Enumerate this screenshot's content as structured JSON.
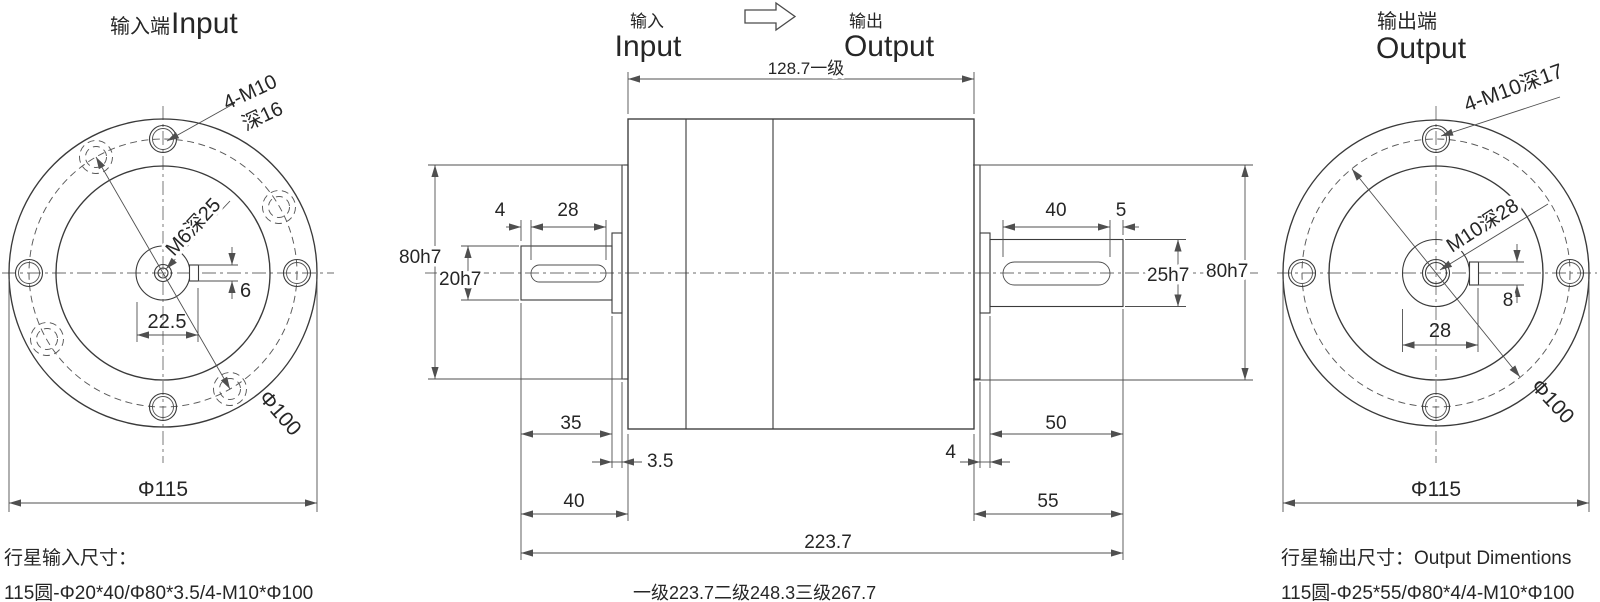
{
  "drawing": {
    "left": {
      "title_cn": "输入端",
      "title_en": "Input",
      "leader_bolts_1": "4-M10",
      "leader_bolts_2": "深16",
      "leader_center": "M6深25",
      "dim_key_offset": "22.5",
      "dim_key_width": "6",
      "dim_bolt_circle": "Φ100",
      "dim_outer": "Φ115",
      "note_title": "行星输入尺寸：",
      "note_spec": "115圆-Φ20*40/Φ80*3.5/4-M10*Φ100"
    },
    "middle": {
      "label_input_cn": "输入",
      "label_input_en": "Input",
      "label_output_cn": "输出",
      "label_output_en": "Output",
      "dim_housing_len": "128.7一级",
      "dim_in_tip_to_key": "4",
      "dim_in_key_len": "28",
      "dim_in_shaft": "20h7",
      "dim_in_boss": "80h7",
      "dim_in_shaft_len": "35",
      "dim_in_step": "3.5",
      "dim_in_total": "40",
      "dim_out_key_len": "40",
      "dim_out_key_to_tip": "5",
      "dim_out_shaft": "25h7",
      "dim_out_boss": "80h7",
      "dim_out_shaft_len": "50",
      "dim_out_step": "4",
      "dim_out_total": "55",
      "dim_overall": "223.7",
      "note_stages": "一级223.7二级248.3三级267.7"
    },
    "right": {
      "title_cn": "输出端",
      "title_en": "Output",
      "leader_bolts": "4-M10深17",
      "leader_center": "M10深28",
      "dim_key_width": "8",
      "dim_key_offset": "28",
      "dim_bolt_circle": "Φ100",
      "dim_outer": "Φ115",
      "note_title": "行星输出尺寸：Output Dimentions",
      "note_spec": "115圆-Φ25*55/Φ80*4/4-M10*Φ100"
    }
  }
}
